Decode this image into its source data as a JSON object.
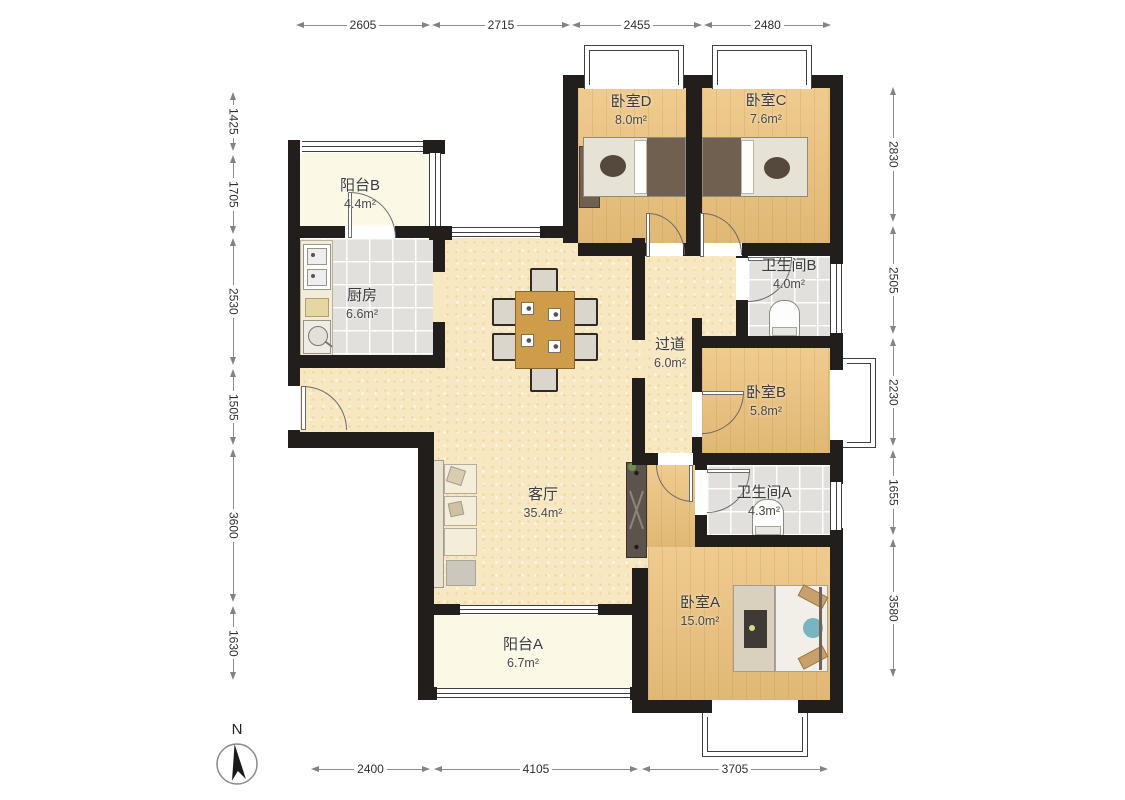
{
  "rooms": {
    "balcony_b": {
      "name": "阳台B",
      "area": "4.4m²"
    },
    "kitchen": {
      "name": "厨房",
      "area": "6.6m²"
    },
    "bedroom_d": {
      "name": "卧室D",
      "area": "8.0m²"
    },
    "bedroom_c": {
      "name": "卧室C",
      "area": "7.6m²"
    },
    "bath_b": {
      "name": "卫生间B",
      "area": "4.0m²"
    },
    "hallway": {
      "name": "过道",
      "area": "6.0m²"
    },
    "bedroom_b": {
      "name": "卧室B",
      "area": "5.8m²"
    },
    "living": {
      "name": "客厅",
      "area": "35.4m²"
    },
    "bath_a": {
      "name": "卫生间A",
      "area": "4.3m²"
    },
    "bedroom_a": {
      "name": "卧室A",
      "area": "15.0m²"
    },
    "balcony_a": {
      "name": "阳台A",
      "area": "6.7m²"
    }
  },
  "dims": {
    "top": [
      "2605",
      "2715",
      "2455",
      "2480"
    ],
    "bottom": [
      "2400",
      "4105",
      "3705"
    ],
    "left": [
      "1425",
      "1705",
      "2530",
      "1505",
      "3600",
      "1630"
    ],
    "right": [
      "2830",
      "2505",
      "2230",
      "1655",
      "3580"
    ]
  },
  "compass": {
    "label": "N"
  },
  "colors": {
    "wall": "#211e1b",
    "wood_floor": "#ecc27b",
    "tile_floor": "#e1e0dd",
    "living_floor": "#f7e8c2",
    "balcony_floor": "#fbf8e6",
    "dining_table": "#cf9c4a",
    "accent_blue": "#7ab4c0"
  }
}
